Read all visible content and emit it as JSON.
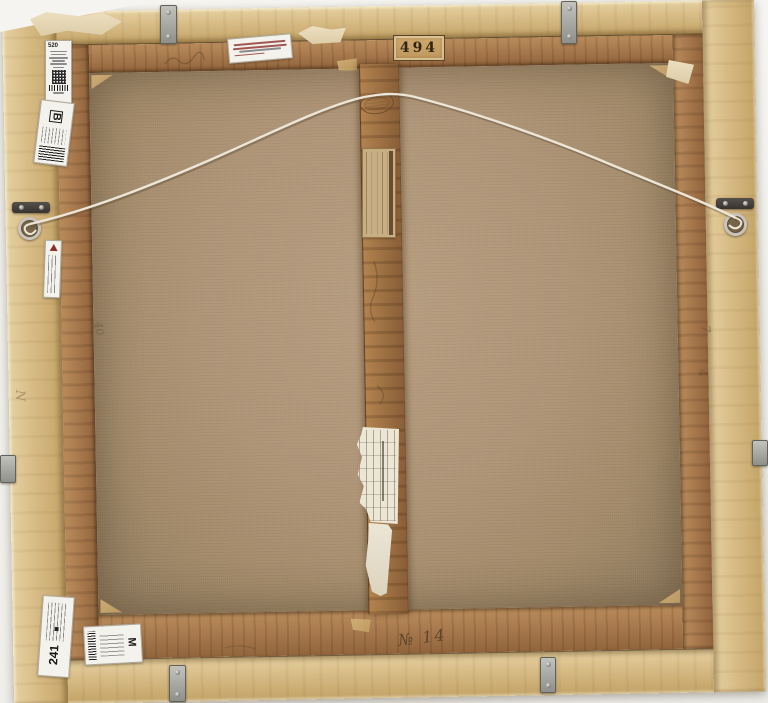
{
  "stamps": {
    "lot_number": "494",
    "oval_maker_stamp": {
      "legible": false
    }
  },
  "labels": {
    "top_left_inventory": {
      "number": "520",
      "features": [
        "qr-code-icon",
        "barcode-icon"
      ],
      "small_print_legible": false,
      "small_print_lines": 6
    },
    "top_left_letter": {
      "letter": "B",
      "features": [
        "barcode-icon"
      ]
    },
    "top_center_exhibition": {
      "legible": false,
      "line_count": 4,
      "ink_color": "#8c2f2a"
    },
    "center_bar_old_label": {
      "legible": false,
      "paper_color": "#c7ae83"
    },
    "left_bar_label": {
      "legible": false,
      "features": [
        "red-triangle-logo"
      ]
    },
    "center_bar_ruled_label": {
      "legible": false
    },
    "center_bar_torn_fragment": {
      "legible": false
    },
    "bottom_left_inventory": {
      "number": "241",
      "small_print_legible": false,
      "small_print_lines": 4
    },
    "bottom_left_letter": {
      "letter": "M",
      "features": [
        "barcode-icon"
      ]
    }
  },
  "pencil_inscriptions": {
    "bottom_bar": "№ 14",
    "right_bar_marks": [
      "7",
      "4"
    ],
    "left_frame_mark": "N",
    "left_bar_mark": "40"
  },
  "palette": {
    "backdrop": "#f4f3ef",
    "frame_wood": "#d7bb85",
    "stretcher_wood": "#a5764b",
    "canvas": "#af9577",
    "wire": "#ece6d8",
    "metal": "#9b9b97",
    "label_white": "#f4f2ec",
    "label_tan": "#c7ae83",
    "red_ink": "#8c2f2a",
    "pencil": "#4c3a24"
  }
}
